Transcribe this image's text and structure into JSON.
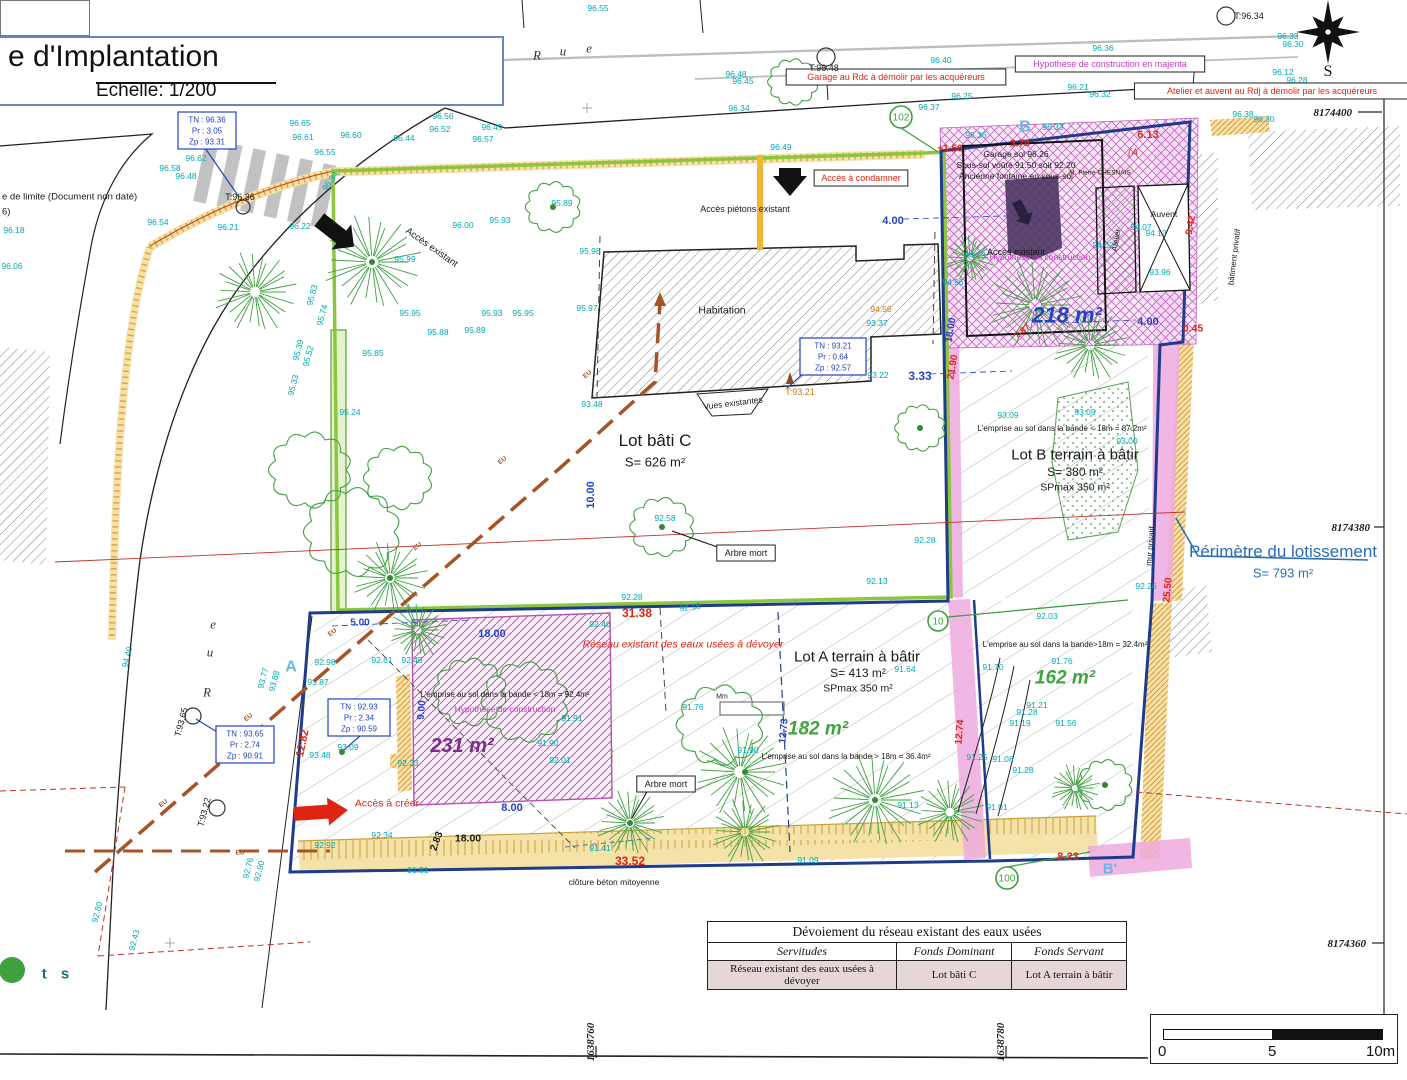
{
  "palette": {
    "cyan": "#00A9B4",
    "blue": "#2443C2",
    "navy": "#1E3B8C",
    "red": "#E02412",
    "darkred": "#C03028",
    "magenta": "#C837C8",
    "purple": "#7B2D8B",
    "green": "#3FA33F",
    "treegreen": "#3FA040",
    "limegreen": "#8CC63F",
    "brown": "#A65326",
    "orangetext": "#C87818",
    "orange": "#D98A2B",
    "steelblue": "#2A6DB5",
    "lightblue": "#69B8E0",
    "tealdark": "#1a6b8a",
    "pink": "#ECA8DC",
    "black": "#1a1a1a"
  },
  "title_block": {
    "title": "e d'Implantation",
    "scale": "Echelle: 1/200"
  },
  "side_note": {
    "line1": "e de limite (Document non daté)",
    "line2": "6)"
  },
  "compass": {
    "label": "S"
  },
  "streets": {
    "top": [
      {
        "ch": "R",
        "x": 537,
        "y": 55
      },
      {
        "ch": "u",
        "x": 563,
        "y": 51
      },
      {
        "ch": "e",
        "x": 589,
        "y": 48
      }
    ],
    "left": [
      {
        "ch": "e",
        "x": 213,
        "y": 624
      },
      {
        "ch": "u",
        "x": 210,
        "y": 652
      },
      {
        "ch": "R",
        "x": 207,
        "y": 692
      }
    ]
  },
  "grid_labels": [
    {
      "t": "8174400",
      "x": 1352,
      "y": 112,
      "a": "end"
    },
    {
      "t": "8174380",
      "x": 1370,
      "y": 527,
      "a": "end"
    },
    {
      "t": "8174360",
      "x": 1366,
      "y": 943,
      "a": "end"
    },
    {
      "t": "1638760",
      "x": 590,
      "y": 1042,
      "r": -90
    },
    {
      "t": "1638780",
      "x": 1000,
      "y": 1042,
      "r": -90
    }
  ],
  "perimeter": {
    "label": "Périmètre du lotissement",
    "area": "S= 793 m²",
    "x": 1283,
    "y": 551
  },
  "parcel_labels": [
    {
      "t": "Lot bâti C",
      "x": 655,
      "y": 440,
      "s": 17
    },
    {
      "t": "S= 626 m²",
      "x": 655,
      "y": 462,
      "s": 13
    },
    {
      "t": "Lot B terrain à bâtir",
      "x": 1075,
      "y": 454,
      "s": 15
    },
    {
      "t": "S= 380 m²",
      "x": 1075,
      "y": 472,
      "s": 12
    },
    {
      "t": "SPmax 350 m²",
      "x": 1075,
      "y": 487,
      "s": 10.5
    },
    {
      "t": "Lot A terrain à bâtir",
      "x": 857,
      "y": 656,
      "s": 15
    },
    {
      "t": "S= 413 m²",
      "x": 858,
      "y": 673,
      "s": 12
    },
    {
      "t": "SPmax 350 m²",
      "x": 858,
      "y": 688,
      "s": 10.5
    }
  ],
  "area_labels": [
    {
      "t": "218 m²",
      "x": 1067,
      "y": 315,
      "s": 22,
      "c": "blue"
    },
    {
      "t": "231 m²",
      "x": 462,
      "y": 745,
      "s": 20,
      "c": "purple"
    },
    {
      "t": "182 m²",
      "x": 818,
      "y": 728,
      "s": 19,
      "c": "green"
    },
    {
      "t": "162 m²",
      "x": 1065,
      "y": 677,
      "s": 19,
      "c": "green"
    }
  ],
  "emprise_notes": [
    {
      "t": "L'emprise au sol dans la bande < 18m = 87.2m²",
      "x": 1062,
      "y": 428
    },
    {
      "t": "L'emprise au sol dans la bande < 18m = 92.4m²",
      "x": 505,
      "y": 694
    },
    {
      "t": "L'emprise au sol dans la bande > 18m = 36.4m²",
      "x": 846,
      "y": 756
    },
    {
      "t": "L'emprise au sol dans la bande>18m = 32.4m²",
      "x": 1065,
      "y": 644
    }
  ],
  "annotations": [
    {
      "t": "Accès piétons existant",
      "x": 745,
      "y": 209,
      "s": 9
    },
    {
      "t": "Accès existant",
      "x": 432,
      "y": 247,
      "s": 9.5,
      "r": 35
    },
    {
      "t": "Accès existant",
      "x": 1016,
      "y": 252,
      "s": 9
    },
    {
      "t": "Habitation",
      "x": 722,
      "y": 310,
      "s": 10.5
    },
    {
      "t": "Vues existantes",
      "x": 733,
      "y": 403,
      "s": 8.5,
      "r": -7
    },
    {
      "t": "clôture béton mitoyenne",
      "x": 614,
      "y": 882,
      "s": 8.5
    },
    {
      "t": "Arbre mort",
      "x": 746,
      "y": 553,
      "s": 9,
      "box": 1
    },
    {
      "t": "Arbre mort",
      "x": 666,
      "y": 784,
      "s": 9,
      "box": 1
    },
    {
      "t": "bâtiment privatif",
      "x": 1234,
      "y": 257,
      "s": 8,
      "r": -83
    },
    {
      "t": "mur privatif",
      "x": 1150,
      "y": 546,
      "s": 8,
      "r": -85
    },
    {
      "t": "M. Pierre CHESNAIS",
      "x": 1100,
      "y": 172,
      "s": 6.5
    },
    {
      "t": "Garage sol 96.26",
      "x": 1016,
      "y": 154,
      "s": 8.5
    },
    {
      "t": "Sous-sol voûté 91.50 soit 92.20",
      "x": 1016,
      "y": 165,
      "s": 8.5
    },
    {
      "t": "Ancienne fontaine en sous-sol",
      "x": 1016,
      "y": 176,
      "s": 8.5
    },
    {
      "t": "Garage au Rdc à démolir par les acquéreurs",
      "x": 896,
      "y": 77,
      "s": 9,
      "c": "red",
      "box": 1
    },
    {
      "t": "Atelier et auvent au Rdj à démolir par les acquéreurs",
      "x": 1272,
      "y": 91,
      "s": 9,
      "c": "red",
      "box": 1
    },
    {
      "t": "Accès à condamner",
      "x": 861,
      "y": 178,
      "s": 9,
      "c": "red",
      "box": 1
    },
    {
      "t": "Accès à créer",
      "x": 387,
      "y": 803,
      "s": 10.5,
      "c": "red"
    },
    {
      "t": "Réseau existant des eaux usées à dévoyer",
      "x": 683,
      "y": 644,
      "s": 10.5,
      "c": "red",
      "i": 1
    },
    {
      "t": "Hypothèse de construction en majenta",
      "x": 1110,
      "y": 64,
      "s": 9,
      "c": "magenta",
      "box": 1
    },
    {
      "t": "Hypothèse de construction",
      "x": 1040,
      "y": 257,
      "s": 8.5,
      "c": "magenta"
    },
    {
      "t": "Hypothèse de construction",
      "x": 505,
      "y": 709,
      "s": 8.5,
      "c": "magenta"
    },
    {
      "t": "(A",
      "x": 1133,
      "y": 152,
      "s": 10,
      "c": "red",
      "i": 1
    },
    {
      "t": "Atelier",
      "x": 1116,
      "y": 240,
      "s": 8,
      "r": -80
    },
    {
      "t": "Auvent",
      "x": 1164,
      "y": 214,
      "s": 8.5
    },
    {
      "t": "B",
      "x": 1025,
      "y": 126,
      "s": 16,
      "c": "lightblue",
      "b": 1
    },
    {
      "t": "A",
      "x": 291,
      "y": 666,
      "s": 16,
      "c": "lightblue",
      "b": 1
    },
    {
      "t": "B'",
      "x": 1110,
      "y": 868,
      "s": 15,
      "c": "lightblue",
      "b": 1
    },
    {
      "t": "t s",
      "x": 58,
      "y": 973,
      "s": 15,
      "c": "tealdark",
      "b": 1,
      "ls": 5
    },
    {
      "t": "e de limite (Document non daté)",
      "x": 2,
      "y": 196,
      "s": 9.5,
      "a": "start"
    },
    {
      "t": "6)",
      "x": 2,
      "y": 211,
      "s": 9.5,
      "a": "start"
    },
    {
      "t": "Mm",
      "x": 722,
      "y": 696,
      "s": 7
    }
  ],
  "eu_labels": [
    {
      "t": "EU",
      "x": 163,
      "y": 803,
      "r": -40
    },
    {
      "t": "EU",
      "x": 248,
      "y": 717,
      "r": -40
    },
    {
      "t": "EU",
      "x": 332,
      "y": 632,
      "r": -40
    },
    {
      "t": "EU",
      "x": 417,
      "y": 546,
      "r": -40
    },
    {
      "t": "EU",
      "x": 502,
      "y": 460,
      "r": -40
    },
    {
      "t": "EU",
      "x": 587,
      "y": 374,
      "r": -40
    },
    {
      "t": "EU",
      "x": 240,
      "y": 852
    }
  ],
  "dimensions": [
    {
      "t": "4.00",
      "x": 893,
      "y": 220,
      "s": 11
    },
    {
      "t": "4.00",
      "x": 1148,
      "y": 321,
      "s": 11
    },
    {
      "t": "3.33",
      "x": 920,
      "y": 376,
      "s": 12
    },
    {
      "t": "10.00",
      "x": 590,
      "y": 495,
      "s": 11,
      "r": -90
    },
    {
      "t": "18.00",
      "x": 950,
      "y": 330,
      "s": 10,
      "r": -80
    },
    {
      "t": "5.00",
      "x": 360,
      "y": 622,
      "s": 10
    },
    {
      "t": "18.00",
      "x": 492,
      "y": 633,
      "s": 11
    },
    {
      "t": "8.00",
      "x": 512,
      "y": 807,
      "s": 11
    },
    {
      "t": "9.00",
      "x": 421,
      "y": 710,
      "s": 10,
      "r": -85
    },
    {
      "t": "12.73",
      "x": 783,
      "y": 731,
      "s": 10,
      "r": -85
    },
    {
      "t": "18.00",
      "x": 468,
      "y": 838,
      "s": 10.5,
      "c": "black"
    },
    {
      "t": "2.83",
      "x": 436,
      "y": 841,
      "s": 10,
      "r": -70,
      "c": "black"
    },
    {
      "t": "31.38",
      "x": 637,
      "y": 613,
      "s": 12,
      "c": "red"
    },
    {
      "t": "33.52",
      "x": 630,
      "y": 861,
      "s": 12,
      "c": "red"
    },
    {
      "t": "12.82",
      "x": 302,
      "y": 743,
      "s": 11,
      "r": -78,
      "c": "red"
    },
    {
      "t": "12.74",
      "x": 959,
      "y": 732,
      "s": 10,
      "r": -85,
      "c": "red"
    },
    {
      "t": "8.23",
      "x": 1068,
      "y": 856,
      "s": 11,
      "c": "red"
    },
    {
      "t": "21.90",
      "x": 952,
      "y": 367,
      "s": 10,
      "r": -80,
      "c": "red"
    },
    {
      "t": "25.50",
      "x": 1167,
      "y": 590,
      "s": 10,
      "r": -85,
      "c": "red"
    },
    {
      "t": "9.42",
      "x": 1190,
      "y": 225,
      "s": 10,
      "r": -80,
      "c": "red"
    },
    {
      "t": "0.45",
      "x": 1193,
      "y": 328,
      "s": 10.5,
      "c": "red"
    },
    {
      "t": "6.13",
      "x": 1148,
      "y": 134,
      "s": 11,
      "c": "red"
    },
    {
      "t": "+1.50",
      "x": 950,
      "y": 148,
      "s": 10,
      "c": "red"
    },
    {
      "t": "3.78",
      "x": 1020,
      "y": 143,
      "s": 10,
      "c": "red"
    },
    {
      "t": "7.87",
      "x": 1022,
      "y": 331,
      "s": 9,
      "r": -40,
      "c": "red"
    }
  ],
  "spot_elevations": [
    {
      "t": "96.55",
      "x": 598,
      "y": 8
    },
    {
      "t": "96.55",
      "x": 325,
      "y": 152
    },
    {
      "t": "96.65",
      "x": 300,
      "y": 123
    },
    {
      "t": "96.61",
      "x": 303,
      "y": 137
    },
    {
      "t": "96.60",
      "x": 351,
      "y": 135
    },
    {
      "t": "96.56",
      "x": 443,
      "y": 116
    },
    {
      "t": "96.52",
      "x": 440,
      "y": 129
    },
    {
      "t": "96.49",
      "x": 492,
      "y": 127
    },
    {
      "t": "96.57",
      "x": 483,
      "y": 139
    },
    {
      "t": "96.44",
      "x": 404,
      "y": 138
    },
    {
      "t": "96.62",
      "x": 196,
      "y": 158
    },
    {
      "t": "96.58",
      "x": 170,
      "y": 168
    },
    {
      "t": "96.48",
      "x": 186,
      "y": 176
    },
    {
      "t": "96.54",
      "x": 158,
      "y": 222
    },
    {
      "t": "96.21",
      "x": 228,
      "y": 227
    },
    {
      "t": "96.22",
      "x": 300,
      "y": 226
    },
    {
      "t": "96.34",
      "x": 330,
      "y": 181,
      "r": -55
    },
    {
      "t": "96.48",
      "x": 736,
      "y": 74
    },
    {
      "t": "96.45",
      "x": 743,
      "y": 81
    },
    {
      "t": "96.40",
      "x": 941,
      "y": 60
    },
    {
      "t": "96.34",
      "x": 739,
      "y": 108
    },
    {
      "t": "96.37",
      "x": 929,
      "y": 107
    },
    {
      "t": "96.25",
      "x": 962,
      "y": 96
    },
    {
      "t": "96.36",
      "x": 976,
      "y": 135
    },
    {
      "t": "96.49",
      "x": 781,
      "y": 147
    },
    {
      "t": "96.33",
      "x": 1288,
      "y": 36
    },
    {
      "t": "96.30",
      "x": 1293,
      "y": 44
    },
    {
      "t": "96.36",
      "x": 1103,
      "y": 48
    },
    {
      "t": "96.12",
      "x": 1283,
      "y": 72
    },
    {
      "t": "96.28",
      "x": 1297,
      "y": 80
    },
    {
      "t": "96.21",
      "x": 1078,
      "y": 87
    },
    {
      "t": "96.32",
      "x": 1100,
      "y": 94
    },
    {
      "t": "96.33",
      "x": 1053,
      "y": 127
    },
    {
      "t": "96.38",
      "x": 1243,
      "y": 114
    },
    {
      "t": "96.30",
      "x": 1264,
      "y": 119
    },
    {
      "t": "96.00",
      "x": 463,
      "y": 225
    },
    {
      "t": "95.93",
      "x": 500,
      "y": 220
    },
    {
      "t": "95.89",
      "x": 562,
      "y": 203
    },
    {
      "t": "95.98",
      "x": 590,
      "y": 251
    },
    {
      "t": "95.99",
      "x": 405,
      "y": 259
    },
    {
      "t": "95.95",
      "x": 410,
      "y": 313
    },
    {
      "t": "95.93",
      "x": 492,
      "y": 313
    },
    {
      "t": "95.95",
      "x": 523,
      "y": 313
    },
    {
      "t": "95.97",
      "x": 587,
      "y": 308
    },
    {
      "t": "95.88",
      "x": 438,
      "y": 332
    },
    {
      "t": "95.89",
      "x": 475,
      "y": 330
    },
    {
      "t": "95.85",
      "x": 373,
      "y": 353
    },
    {
      "t": "95.83",
      "x": 312,
      "y": 295,
      "r": -75
    },
    {
      "t": "95.74",
      "x": 322,
      "y": 315,
      "r": -75
    },
    {
      "t": "95.39",
      "x": 298,
      "y": 350,
      "r": -75
    },
    {
      "t": "95.52",
      "x": 308,
      "y": 356,
      "r": -75
    },
    {
      "t": "95.33",
      "x": 293,
      "y": 385,
      "r": -75
    },
    {
      "t": "95.24",
      "x": 350,
      "y": 412
    },
    {
      "t": "94.99",
      "x": 975,
      "y": 255
    },
    {
      "t": "94.96",
      "x": 953,
      "y": 282
    },
    {
      "t": "94.07",
      "x": 1141,
      "y": 227
    },
    {
      "t": "94.12",
      "x": 1156,
      "y": 233
    },
    {
      "t": "94.02",
      "x": 1103,
      "y": 245
    },
    {
      "t": "93.96",
      "x": 1160,
      "y": 272
    },
    {
      "t": "94.56",
      "x": 881,
      "y": 309,
      "c": "orangetext"
    },
    {
      "t": "93.37",
      "x": 877,
      "y": 323
    },
    {
      "t": "93.48",
      "x": 592,
      "y": 404
    },
    {
      "t": "93.22",
      "x": 878,
      "y": 375
    },
    {
      "t": "93.09",
      "x": 1008,
      "y": 415
    },
    {
      "t": "93.09",
      "x": 1085,
      "y": 412
    },
    {
      "t": "93.00",
      "x": 1127,
      "y": 441
    },
    {
      "t": "92.28",
      "x": 925,
      "y": 540
    },
    {
      "t": "92.26",
      "x": 1146,
      "y": 586
    },
    {
      "t": "92.13",
      "x": 877,
      "y": 581
    },
    {
      "t": "92.28",
      "x": 632,
      "y": 597
    },
    {
      "t": "92.18",
      "x": 690,
      "y": 607,
      "r": -8
    },
    {
      "t": "92.03",
      "x": 1047,
      "y": 616
    },
    {
      "t": "92.98",
      "x": 325,
      "y": 662
    },
    {
      "t": "92.61",
      "x": 382,
      "y": 660
    },
    {
      "t": "92.45",
      "x": 412,
      "y": 660
    },
    {
      "t": "93.87",
      "x": 318,
      "y": 682
    },
    {
      "t": "93.77",
      "x": 263,
      "y": 678,
      "r": -75
    },
    {
      "t": "93.88",
      "x": 274,
      "y": 681,
      "r": -75
    },
    {
      "t": "93.48",
      "x": 320,
      "y": 755
    },
    {
      "t": "93.09",
      "x": 348,
      "y": 747
    },
    {
      "t": "92.23",
      "x": 408,
      "y": 763
    },
    {
      "t": "92.92",
      "x": 325,
      "y": 845
    },
    {
      "t": "92.76",
      "x": 248,
      "y": 868,
      "r": -75
    },
    {
      "t": "92.90",
      "x": 259,
      "y": 871,
      "r": -75
    },
    {
      "t": "92.34",
      "x": 382,
      "y": 835
    },
    {
      "t": "91.51",
      "x": 418,
      "y": 870
    },
    {
      "t": "92.46",
      "x": 600,
      "y": 624
    },
    {
      "t": "91.91",
      "x": 572,
      "y": 718
    },
    {
      "t": "91.90",
      "x": 548,
      "y": 743
    },
    {
      "t": "92.01",
      "x": 560,
      "y": 760
    },
    {
      "t": "92.58",
      "x": 665,
      "y": 518
    },
    {
      "t": "91.64",
      "x": 905,
      "y": 669
    },
    {
      "t": "91.76",
      "x": 693,
      "y": 707
    },
    {
      "t": "91.90",
      "x": 748,
      "y": 750
    },
    {
      "t": "91.41",
      "x": 600,
      "y": 848
    },
    {
      "t": "91.09",
      "x": 808,
      "y": 860
    },
    {
      "t": "91.13",
      "x": 908,
      "y": 805
    },
    {
      "t": "91.70",
      "x": 993,
      "y": 667
    },
    {
      "t": "91.76",
      "x": 1062,
      "y": 661
    },
    {
      "t": "91.21",
      "x": 1037,
      "y": 705
    },
    {
      "t": "91.28",
      "x": 1027,
      "y": 712
    },
    {
      "t": "91.19",
      "x": 1020,
      "y": 723
    },
    {
      "t": "91.56",
      "x": 1066,
      "y": 723
    },
    {
      "t": "91.25",
      "x": 977,
      "y": 757
    },
    {
      "t": "91.08",
      "x": 1003,
      "y": 759
    },
    {
      "t": "91.28",
      "x": 1023,
      "y": 770
    },
    {
      "t": "91.01",
      "x": 997,
      "y": 807
    },
    {
      "t": "96.18",
      "x": 14,
      "y": 230
    },
    {
      "t": "96.06",
      "x": 12,
      "y": 266
    },
    {
      "t": "94.40",
      "x": 127,
      "y": 657,
      "r": -75
    },
    {
      "t": "92.80",
      "x": 97,
      "y": 912,
      "r": -75
    },
    {
      "t": "92.43",
      "x": 134,
      "y": 940,
      "r": -75
    }
  ],
  "point_markers": [
    {
      "t": "T:96.36",
      "x": 240,
      "y": 197,
      "cx": 243,
      "cy": 207,
      "cr": 7
    },
    {
      "t": "T:96.48",
      "x": 824,
      "y": 68,
      "cx": 826,
      "cy": 57,
      "cr": 9
    },
    {
      "t": "T:96.34",
      "x": 1249,
      "y": 16,
      "cx": 1226,
      "cy": 16,
      "cr": 9
    },
    {
      "t": "T:93.21",
      "x": 800,
      "y": 392,
      "c": "orangetext"
    },
    {
      "t": "T:93.65",
      "x": 181,
      "y": 722,
      "r": -75,
      "cx": 193,
      "cy": 716,
      "cr": 8
    },
    {
      "t": "T:93.22",
      "x": 204,
      "y": 812,
      "r": -75,
      "cx": 217,
      "cy": 808,
      "cr": 8
    }
  ],
  "survey_boxes": [
    {
      "lines": [
        "TN : 96.36",
        "Pr : 3.05",
        "Zp : 93.31"
      ],
      "x": 178,
      "y": 112,
      "w": 58,
      "h": 37
    },
    {
      "lines": [
        "TN : 93.21",
        "Pr : 0.64",
        "Zp : 92.57"
      ],
      "x": 800,
      "y": 338,
      "w": 66,
      "h": 37
    },
    {
      "lines": [
        "TN : 92.93",
        "Pr : 2.34",
        "Zp : 90.59"
      ],
      "x": 328,
      "y": 699,
      "w": 62,
      "h": 37
    },
    {
      "lines": [
        "TN : 93.65",
        "Pr : 2.74",
        "Zp : 90.91"
      ],
      "x": 216,
      "y": 726,
      "w": 58,
      "h": 37
    }
  ],
  "circled_points": [
    {
      "t": "102",
      "x": 901,
      "y": 117,
      "r": 11
    },
    {
      "t": "10",
      "x": 938,
      "y": 621,
      "r": 10
    },
    {
      "t": "100",
      "x": 1007,
      "y": 878,
      "r": 11
    }
  ],
  "table": {
    "title": "Dévoiement du réseau existant des eaux usées",
    "headers": [
      "Servitudes",
      "Fonds Dominant",
      "Fonds Servant"
    ],
    "rows": [
      [
        "Réseau existant des eaux usées à dévoyer",
        "Lot bâti C",
        "Lot A terrain à bâtir"
      ]
    ]
  },
  "scale_bar": {
    "labels": [
      "0",
      "5",
      "10m"
    ]
  }
}
